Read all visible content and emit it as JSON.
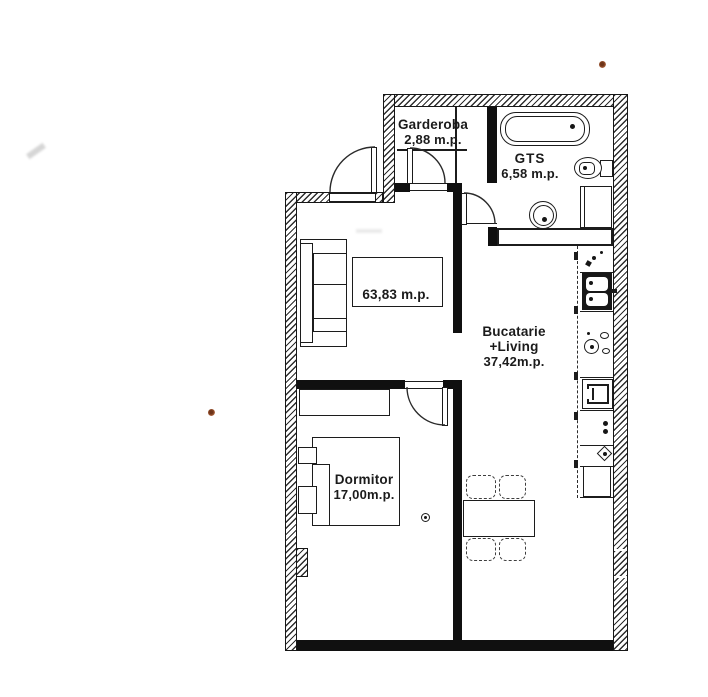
{
  "document": {
    "type": "apartment-floor-plan"
  },
  "rooms": {
    "garderoba": {
      "name": "Garderoba",
      "area": "2,88 m.p."
    },
    "gts": {
      "name": "GTS",
      "area": "6,58 m.p."
    },
    "bucatarie_living": {
      "name_line1": "Bucatarie",
      "name_line2": "+Living",
      "area": "37,42m.p."
    },
    "dormitor": {
      "name": "Dormitor",
      "area": "17,00m.p."
    },
    "total": {
      "area": "63,83 m.p."
    }
  },
  "fixtures": [
    "bathtub",
    "toilet",
    "washbasin",
    "shower-cabinet",
    "kitchen-counter",
    "kitchen-sink",
    "cooktop",
    "oven",
    "refrigerator",
    "dining-table",
    "dining-chair",
    "sofa",
    "coffee-table",
    "bed",
    "pillow",
    "dresser",
    "entry-door",
    "garderoba-door",
    "gts-door",
    "bedroom-door"
  ],
  "colors": {
    "paper": "#ffffff",
    "line": "#1c1c1c",
    "partition": "#101010",
    "hatch": "#2e2e2e",
    "scan_artifact": "#a65c36"
  }
}
